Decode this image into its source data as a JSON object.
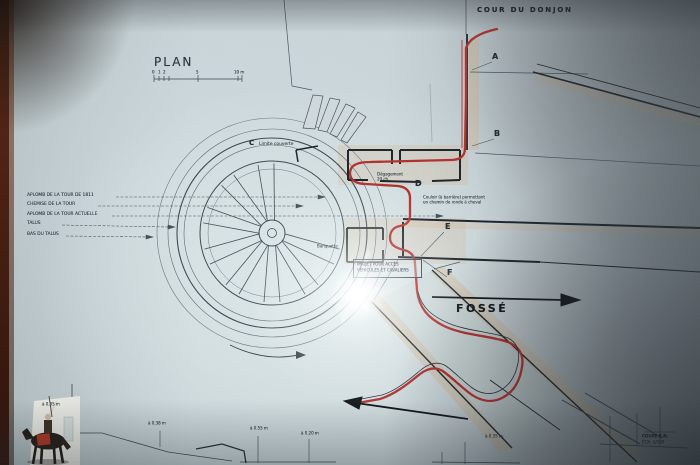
{
  "plan": {
    "title": "PLAN",
    "areas": {
      "courtyard": "COUR DU DONJON",
      "moat": "FOSSÉ"
    },
    "points": {
      "a": "A",
      "b": "B",
      "c": "C",
      "d": "D",
      "e": "E",
      "f": "F"
    },
    "c_note": "Limite couverte",
    "d_note_line1": "Couloir (à barrière) permettant",
    "d_note_line2": "un chemin de ronde à cheval",
    "clearance_line1": "Dégagement",
    "clearance_line2": "20 ch.",
    "banquette": "Banquette",
    "project_line1": "PROJET POUR ACCÈS",
    "project_line2": "VÉHICULES ET CAVALIERS",
    "left_legend": [
      "APLOMB DE LA TOUR DE 1811",
      "CHEMISE DE LA TOUR",
      "APLOMB DE LA TOUR ACTUELLE",
      "TALUS",
      "BAS DU TALUS"
    ],
    "scale_labels": [
      "0",
      "1",
      "2",
      "5",
      "10 m"
    ],
    "dimensions": [
      "à 0.35 m",
      "à 0.38 m",
      "à 0.55 m",
      "à 0.20 m",
      "à 0.35 m."
    ],
    "title_block": [
      "COUPE B.N.",
      "ÉCH. 1/100"
    ],
    "colors": {
      "route_red": "#b23230",
      "ink": "#3f4c55",
      "wall": "#20262c"
    }
  }
}
